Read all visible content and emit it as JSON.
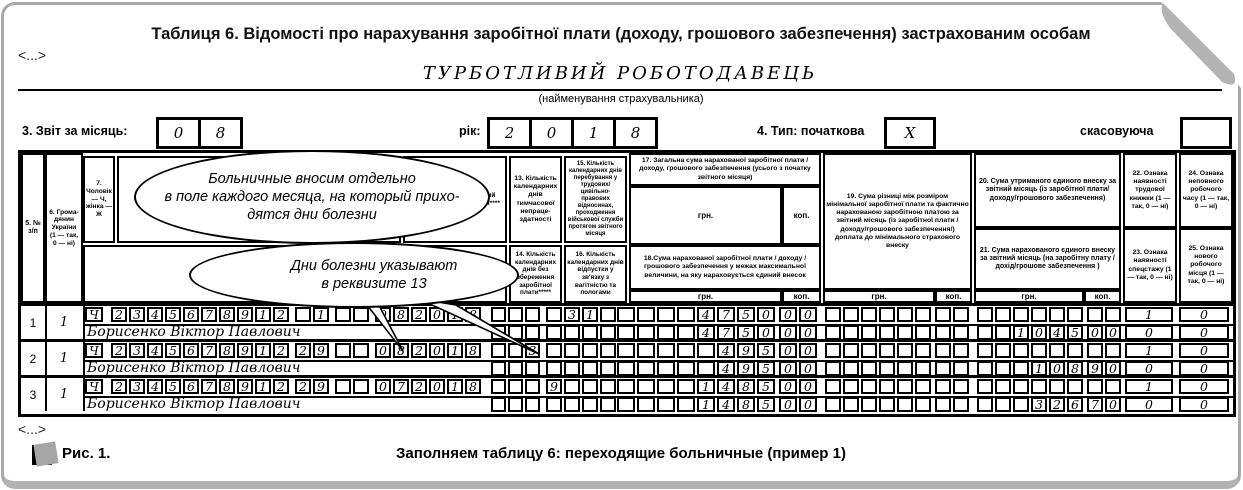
{
  "card": {
    "title": "Таблиця 6. Відомості про нарахування заробітної плати (доходу, грошового забезпечення) застрахованим особам",
    "snip_top": "<...>",
    "snip_bottom": "<...>",
    "employer": {
      "name": "ТУРБОТЛИВИЙ РОБОТОДАВЕЦЬ",
      "caption": "(найменування страхувальника)"
    },
    "controls": {
      "month_label": "3. Звіт за місяць:",
      "month_boxes": [
        "0",
        "8"
      ],
      "year_label": "рік:",
      "year_boxes": [
        "2",
        "0",
        "1",
        "8"
      ],
      "type_label": "4. Тип: початкова",
      "type_box": "X",
      "cancel_label": "скасовуюча",
      "cancel_box": ""
    },
    "figure": {
      "label": "Рис. 1.",
      "caption": "Заполняем таблицу 6: переходящие больничные (пример 1)"
    }
  },
  "callouts": [
    {
      "lines": [
        "Больничные вносим отдельно",
        "в поле каждого месяца, на который прихо-",
        "дятся дни болезни"
      ]
    },
    {
      "lines": [
        "Дни болезни указывают",
        "в реквизите 13"
      ]
    }
  ],
  "table": {
    "units": {
      "hrn": "грн.",
      "kop": "коп."
    },
    "headers": {
      "c5": "5. № з/п",
      "c6": "6. Грома- дянин України (1 — так, 0 — ні)",
      "c7": "7. Чоловік — Ч, жінка — Ж",
      "c11": "11. Місяць та рік, за який проведено нарахування****",
      "c13": "13. Кількість календарних днів тимчасової непраце- здатності",
      "c14": "14. Кількість календарних днів без збереження заробітної плати*****",
      "c15": "15. Кількість календарних днів перебування у трудових/ цивільно-правових відносинах, проходження військової служби протягом звітного місяця",
      "c16": "16. Кількість календарних днів відпустки у зв'язку з вагітністю та пологами",
      "c17": "17. Загальна сума нарахованої заробітної плати / доходу, грошового забезпечення (усього з початку звітного місяця)",
      "c18": "18.Сума нарахованої заробітної плати / доходу /грошового забезпечення у межах максимальної величини, на яку нараховується єдиний внесок",
      "c19": "19. Сума різниці між розміром мінімальної заробітної плати та фактично нарахованою заробітною платою за звітний місяць (із заробітної плати / доходу/грошового забезпечення/) доплата до мінімального страхового внеску",
      "c20": "20. Сума утриманого єдиного внеску за звітний місяць (із заробітної плати/ доходу/грошового забезпечення)",
      "c21": "21. Сума нарахованого єдиного внеску за звітний місяць (на заробітну плату / дохід/грошове забезпечення )",
      "c22": "22. Ознака наявності трудової книжки (1 — так, 0 — ні)",
      "c23": "23. Ознака наявності спецстажу (1 — так, 0 — ні)",
      "c24": "24. Ознака неповного робочого часу (1 — так, 0 — ні)",
      "c25": "25. Ознака нового робочого місця (1 — так, 0 — ні)"
    },
    "rows": [
      {
        "num": "1",
        "citizen": "1",
        "sex": "Ч",
        "card": [
          "2",
          "3",
          "4",
          "5",
          "6",
          "7",
          "8",
          "9",
          "1",
          "2"
        ],
        "cat": [
          "",
          "1"
        ],
        "typ": [
          "",
          ""
        ],
        "month": [
          "0",
          "8",
          "2",
          "0",
          "1",
          "8"
        ],
        "d13": [
          "",
          "",
          ""
        ],
        "d15": [
          "",
          "3",
          "1",
          ""
        ],
        "s17g": [
          "",
          "",
          "",
          "",
          "4",
          "7",
          "5",
          "0"
        ],
        "s17k": [
          "0",
          "0"
        ],
        "s19g": [
          "",
          "",
          "",
          "",
          "",
          ""
        ],
        "s19k": [
          "",
          ""
        ],
        "s20g": [
          "",
          "",
          "",
          "",
          "",
          ""
        ],
        "s20k": [
          "",
          ""
        ],
        "f22": "1",
        "f24": "0",
        "name": "Борисенко Віктор Павлович",
        "d14": [
          "",
          "",
          ""
        ],
        "d16": [
          "",
          "",
          "",
          ""
        ],
        "s18g": [
          "",
          "",
          "",
          "",
          "4",
          "7",
          "5",
          "0"
        ],
        "s18k": [
          "0",
          "0"
        ],
        "s19bg": [
          "",
          "",
          "",
          "",
          "",
          ""
        ],
        "s19bk": [
          "",
          ""
        ],
        "s21g": [
          "",
          "",
          "1",
          "0",
          "4",
          "5"
        ],
        "s21k": [
          "0",
          "0"
        ],
        "f23": "0",
        "f25": "0"
      },
      {
        "num": "2",
        "citizen": "1",
        "sex": "Ч",
        "card": [
          "2",
          "3",
          "4",
          "5",
          "6",
          "7",
          "8",
          "9",
          "1",
          "2"
        ],
        "cat": [
          "2",
          "9"
        ],
        "typ": [
          "",
          ""
        ],
        "month": [
          "0",
          "8",
          "2",
          "0",
          "1",
          "8"
        ],
        "d13": [
          "",
          "",
          "3"
        ],
        "d15": [
          "",
          "",
          "",
          ""
        ],
        "s17g": [
          "",
          "",
          "",
          "",
          "",
          "4",
          "9",
          "5"
        ],
        "s17k": [
          "0",
          "0"
        ],
        "s19g": [
          "",
          "",
          "",
          "",
          "",
          ""
        ],
        "s19k": [
          "",
          ""
        ],
        "s20g": [
          "",
          "",
          "",
          "",
          "",
          ""
        ],
        "s20k": [
          "",
          ""
        ],
        "f22": "1",
        "f24": "0",
        "name": "Борисенко Віктор Павлович",
        "d14": [
          "",
          "",
          ""
        ],
        "d16": [
          "",
          "",
          "",
          ""
        ],
        "s18g": [
          "",
          "",
          "",
          "",
          "",
          "4",
          "9",
          "5"
        ],
        "s18k": [
          "0",
          "0"
        ],
        "s19bg": [
          "",
          "",
          "",
          "",
          "",
          ""
        ],
        "s19bk": [
          "",
          ""
        ],
        "s21g": [
          "",
          "",
          "",
          "1",
          "0",
          "8"
        ],
        "s21k": [
          "9",
          "0"
        ],
        "f23": "0",
        "f25": "0"
      },
      {
        "num": "3",
        "citizen": "1",
        "sex": "Ч",
        "card": [
          "2",
          "3",
          "4",
          "5",
          "6",
          "7",
          "8",
          "9",
          "1",
          "2"
        ],
        "cat": [
          "2",
          "9"
        ],
        "typ": [
          "",
          ""
        ],
        "month": [
          "0",
          "7",
          "2",
          "0",
          "1",
          "8"
        ],
        "d13": [
          "",
          "",
          ""
        ],
        "d15": [
          "9",
          "",
          "",
          ""
        ],
        "s17g": [
          "",
          "",
          "",
          "",
          "1",
          "4",
          "8",
          "5"
        ],
        "s17k": [
          "0",
          "0"
        ],
        "s19g": [
          "",
          "",
          "",
          "",
          "",
          ""
        ],
        "s19k": [
          "",
          ""
        ],
        "s20g": [
          "",
          "",
          "",
          "",
          "",
          ""
        ],
        "s20k": [
          "",
          ""
        ],
        "f22": "1",
        "f24": "0",
        "name": "Борисенко Віктор Павлович",
        "d14": [
          "",
          "",
          ""
        ],
        "d16": [
          "",
          "",
          "",
          ""
        ],
        "s18g": [
          "",
          "",
          "",
          "",
          "1",
          "4",
          "8",
          "5"
        ],
        "s18k": [
          "0",
          "0"
        ],
        "s19bg": [
          "",
          "",
          "",
          "",
          "",
          ""
        ],
        "s19bk": [
          "",
          ""
        ],
        "s21g": [
          "",
          "",
          "",
          "3",
          "2",
          "6"
        ],
        "s21k": [
          "7",
          "0"
        ],
        "f23": "0",
        "f25": "0"
      }
    ]
  }
}
